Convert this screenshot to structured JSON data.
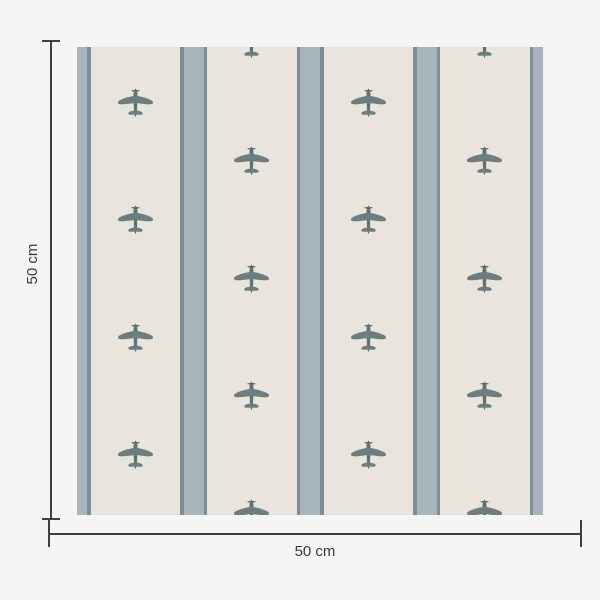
{
  "title": "Wallpaper swatch with airplane stripe pattern",
  "dimensions": {
    "width_label": "50 cm",
    "height_label": "50 cm"
  },
  "colors": {
    "page_bg": "#f5f5f5",
    "swatch_bg": "#e9e5dc",
    "stripe_light": "#a7b5ba",
    "stripe_dark": "#7b8f96",
    "plane_wings": "#6d7e80",
    "plane_body": "#5f7173",
    "dimension_line": "#3f3f3f",
    "label_text": "#3a3a3a"
  },
  "pattern": {
    "columns": 4,
    "column_width": 116.5,
    "stripe_total_width": 27,
    "stripe_light_width": 20,
    "row_spacing": 117.5,
    "phase_a_first_y": 57,
    "phase_b_first_y": -1.75,
    "phase_a_rows": 4,
    "phase_b_rows": 5,
    "plane_width": 37,
    "plane_height": 33
  }
}
